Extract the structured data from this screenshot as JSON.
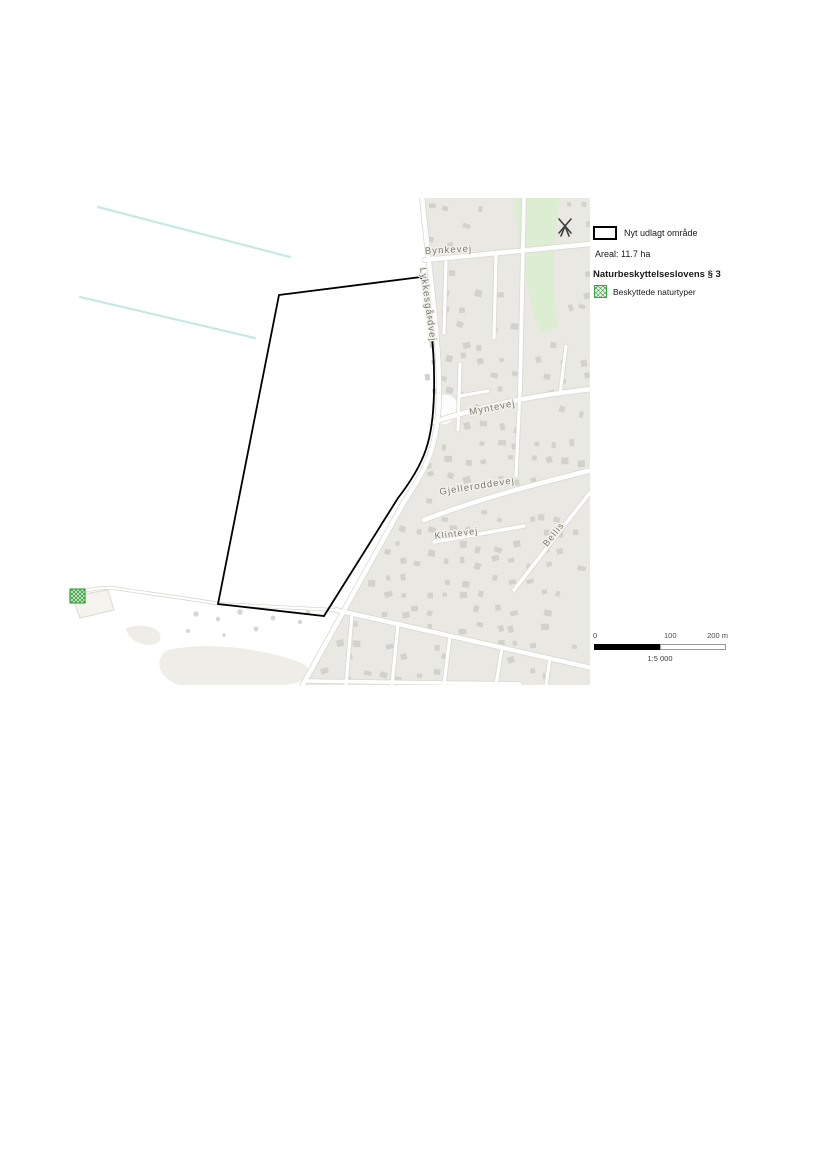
{
  "legend": {
    "new_area_label": "Nyt udlagt område",
    "area_value": "Areal: 11.7 ha",
    "law_header": "Naturbeskyttelseslovens § 3",
    "protected_label": "Beskyttede naturtyper"
  },
  "scalebar": {
    "tick_0": "0",
    "tick_100": "100",
    "tick_200": "200 m",
    "ratio": "1:5 000"
  },
  "map": {
    "streets": {
      "bynkevej": "Bynkevej",
      "lykkesgaardvej": "Lykkesgårdvej",
      "myntevej": "Myntevej",
      "gjelleroddevej": "Gjelleroddevej",
      "klintevej": "Klintevej",
      "bellisvej": "Bellis"
    },
    "icons": {
      "windmill": "windmill",
      "protected_site_marker": "green-hatched-square"
    },
    "colors": {
      "urban_fill": "#e9e8e3",
      "building": "#d2d1cb",
      "road_casing": "#d9d8d2",
      "road_fill": "#ffffff",
      "green_area": "#dcedd2",
      "water_contour": "#c7e9e3",
      "boundary": "#000000",
      "street_label": "#7b7a72",
      "protected_green": "#43a047",
      "beach_fill": "#eeede7"
    }
  }
}
